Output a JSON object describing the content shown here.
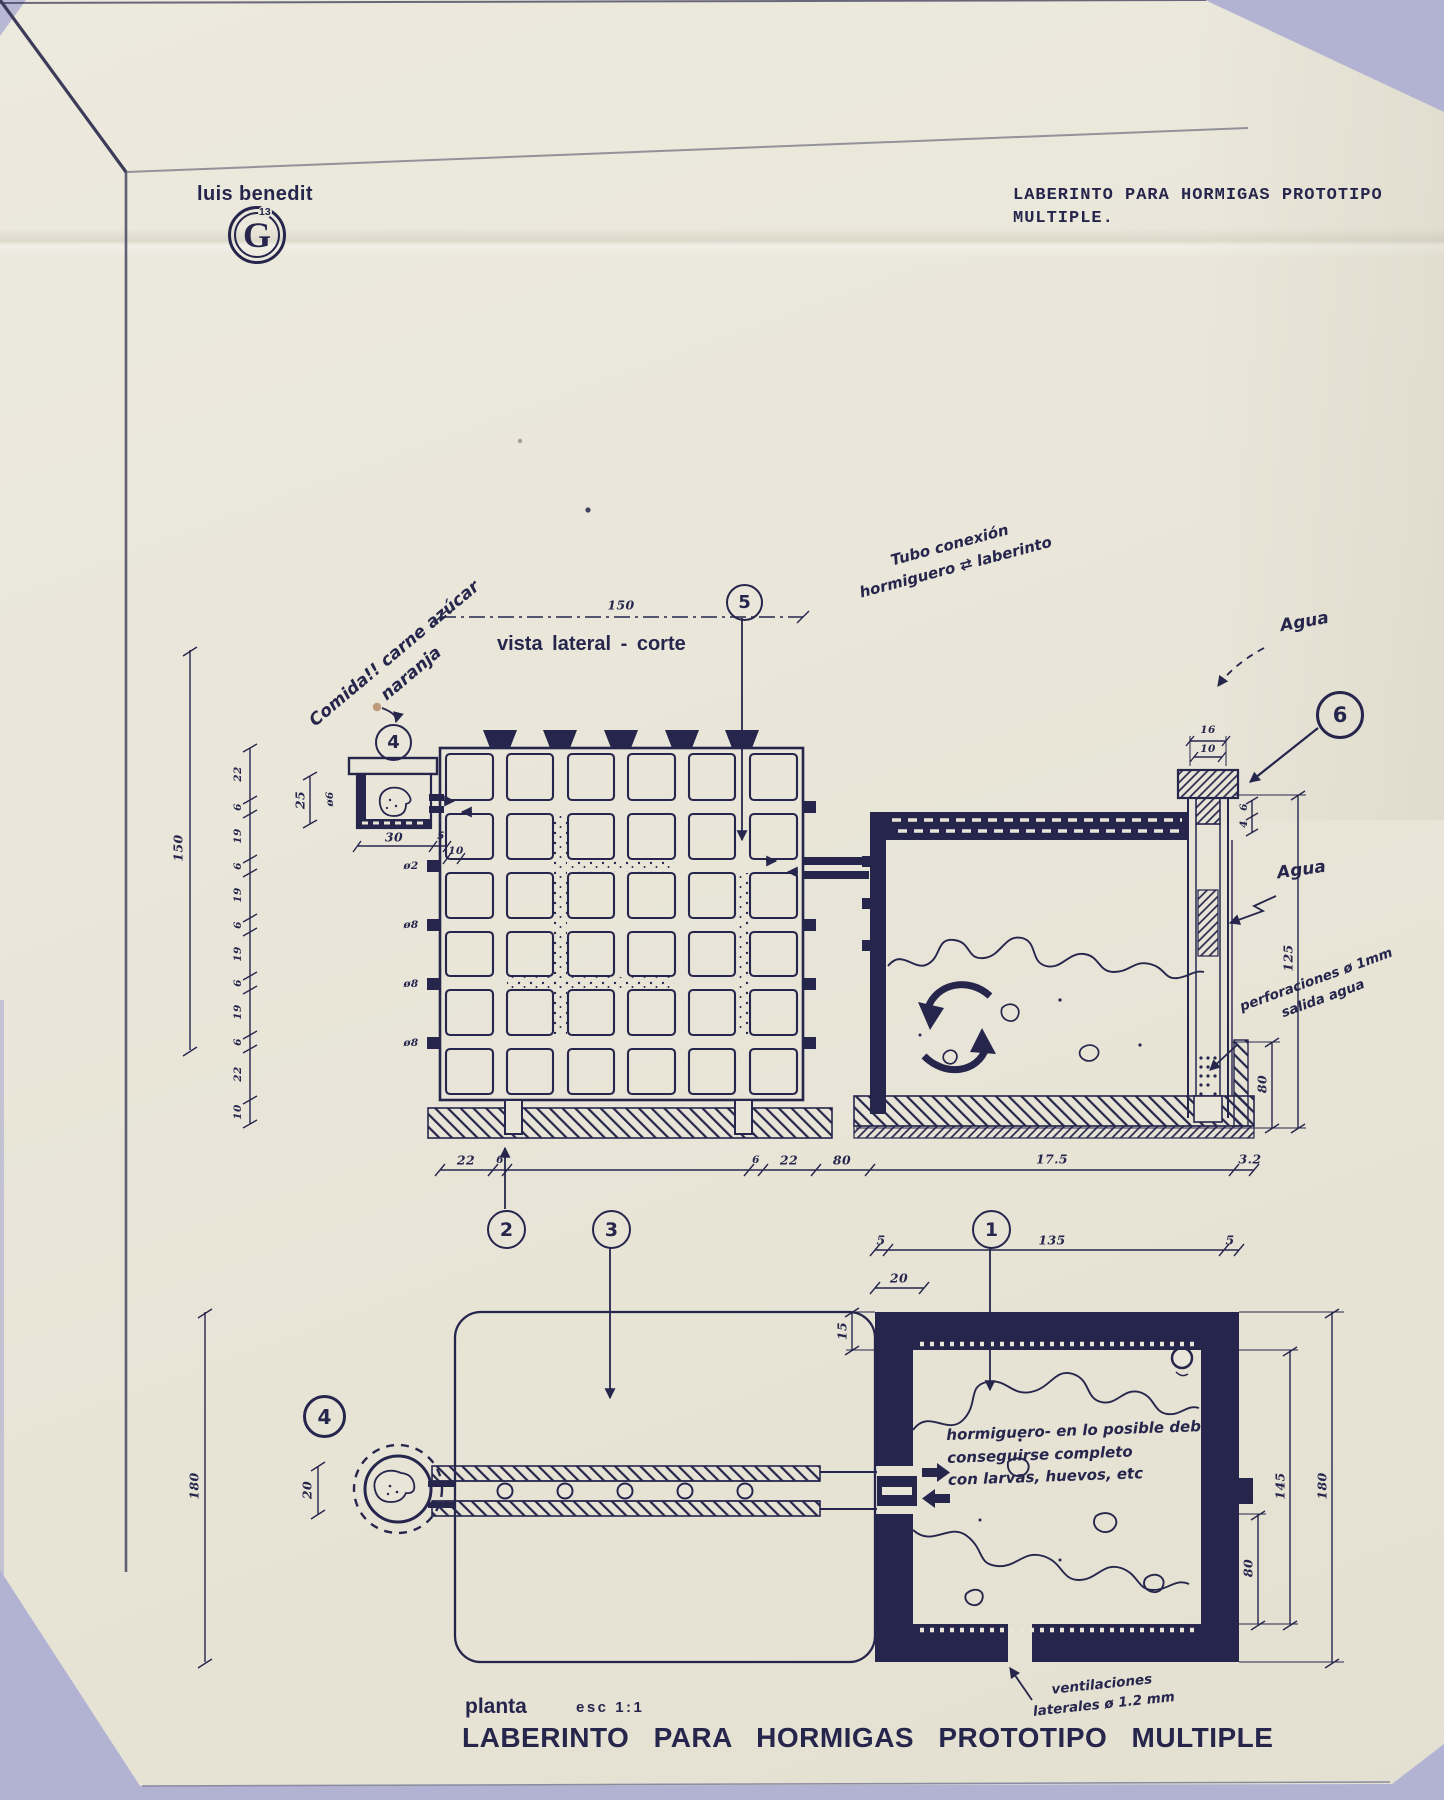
{
  "header": {
    "author": "luis benedit",
    "stamp_letter": "G",
    "stamp_number": "13",
    "title_line1": "LABERINTO PARA HORMIGAS PROTOTIPO",
    "title_line2": "MULTIPLE."
  },
  "callouts": {
    "c1": "1",
    "c2": "2",
    "c3": "3",
    "c4": "4",
    "c5": "5",
    "c6": "6"
  },
  "lateral": {
    "view_label": "vista lateral - corte",
    "note_food_line1": "Comida!! carne azúcar",
    "note_food_line2": "naranja",
    "note_tube_line1": "Tubo conexión",
    "note_tube_line2": "hormiguero ⇄ laberinto",
    "note_agua_top": "Agua",
    "note_agua_side": "Agua",
    "note_perforations_line1": "perforaciones ø 1mm",
    "note_perforations_line2": "salida agua",
    "dim_top_width": "150",
    "dim_left_overall": "150",
    "dim_left_segments": [
      "22",
      "6",
      "19",
      "6",
      "19",
      "6",
      "19",
      "6",
      "19",
      "6",
      "22",
      "10"
    ],
    "dim_feeder_height": "25",
    "dim_feeder_tube": "ø6",
    "dim_feeder_width": "30",
    "dim_feeder_lip": "5",
    "dim_feeder_lip2": "10",
    "hole_labels": [
      "ø2",
      "ø8",
      "ø8",
      "ø8"
    ],
    "dim_bottom_row": [
      "22",
      "6",
      "6",
      "22",
      "80",
      "17.5",
      "3.2"
    ],
    "dim_cap_width_outer": "16",
    "dim_cap_width_inner": "10",
    "dim_rim_small1": "6",
    "dim_rim_small2": "4",
    "dim_box_height": "125",
    "dim_water_depth": "80"
  },
  "plan": {
    "view_label": "planta",
    "scale_label": "esc 1:1",
    "dim_top_left": "5",
    "dim_top_middle": "135",
    "dim_top_right": "5",
    "dim_entry_offset": "20",
    "dim_wall_thickness": "15",
    "dim_left_overall": "180",
    "dim_tube_width": "20",
    "dim_right_inner": "145",
    "dim_right_overall": "180",
    "dim_right_lower": "80",
    "note_hormiguero_line1": "hormiguero- en lo posible debe",
    "note_hormiguero_line2": "conseguirse completo",
    "note_hormiguero_line3": "con larvas, huevos, etc",
    "note_vent_line1": "ventilaciones",
    "note_vent_line2": "laterales ø 1.2 mm"
  },
  "footer": {
    "title": "LABERINTO PARA HORMIGAS PROTOTIPO MULTIPLE"
  },
  "colors": {
    "ink": "#26264d",
    "paper": "#e9e6d9",
    "backdrop": "#b2b3d3"
  }
}
